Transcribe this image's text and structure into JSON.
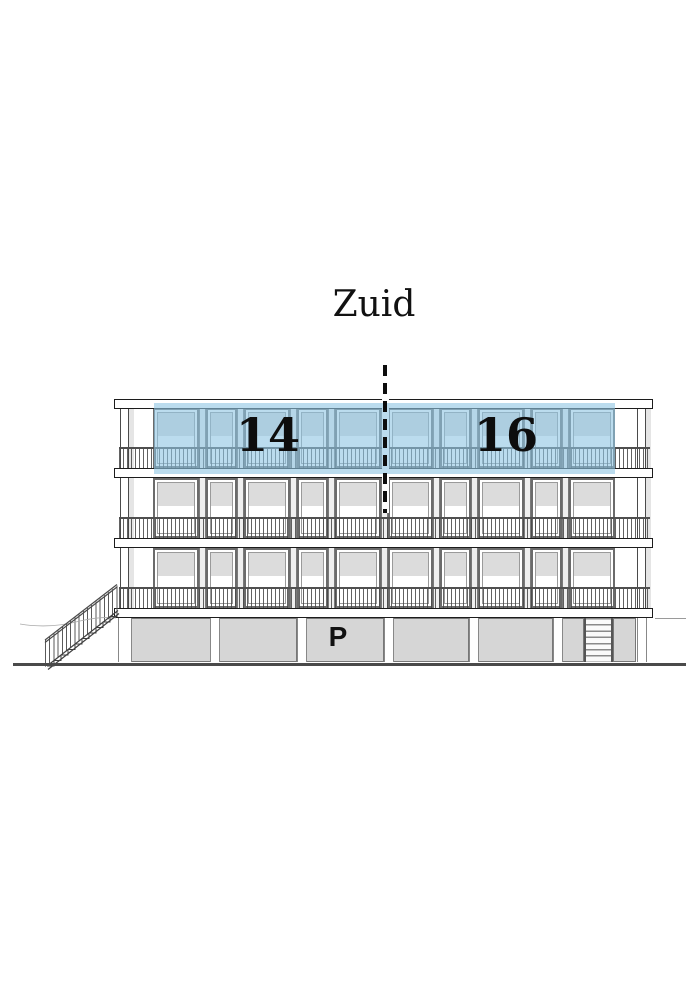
{
  "title": "Zuid",
  "units": {
    "left": {
      "label": "14"
    },
    "right": {
      "label": "16"
    }
  },
  "parking": {
    "label": "P"
  },
  "icons": {
    "section_cut_line": "dashed-section-line",
    "left_stair": "exterior-stair",
    "right_stair": "ladder-stair"
  },
  "colors": {
    "highlight": "rgba(141,196,226,0.60)",
    "window_shade": "#dcdcdc",
    "parking_panel": "#d6d6d6",
    "ground": "#4a4a4a"
  }
}
